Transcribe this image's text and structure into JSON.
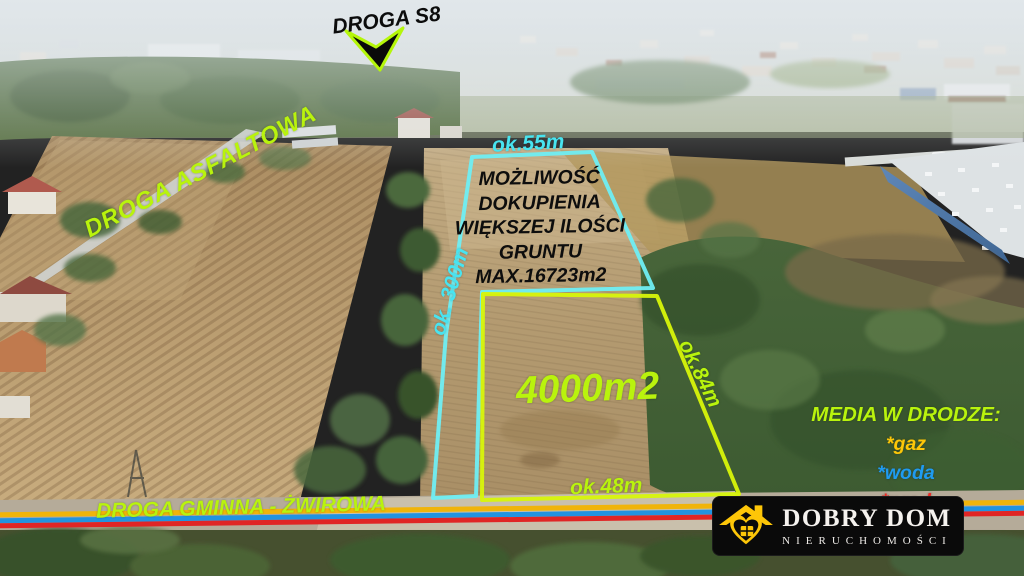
{
  "labels": {
    "droga_s8": "DROGA S8",
    "droga_asfaltowa": "DROGA ASFALTOWA",
    "droga_gminna": "DROGA GMINNA - ŻWIROWA",
    "top_width": "ok.55m",
    "left_length": "ok. 300m",
    "right_length": "ok.84m",
    "bottom_width": "ok.48m",
    "plot_area": "4000m2",
    "offer_lines": [
      "MOŻLIWOŚĆ",
      "DOKUPIENIA",
      "WIĘKSZEJ ILOŚCI",
      "GRUNTU",
      "MAX.16723m2"
    ],
    "media_header": "MEDIA W DRODZE:",
    "media_gaz": "*gaz",
    "media_woda": "*woda",
    "media_prad": "*prąd"
  },
  "logo": {
    "title": "DOBRY DOM",
    "subtitle": "NIERUCHOMOŚCI"
  },
  "colors": {
    "annotation_green": "#b9f30d",
    "annotation_cyan": "#48e4f0",
    "plot_outline_cyan": "#6feef3",
    "plot_outline_yellow": "#d8f50a",
    "gaz_yellow": "#fdc708",
    "woda_blue": "#1f9bf0",
    "prad_red": "#ef2a24",
    "utility_line_gaz": "#f0b40a",
    "utility_line_woda": "#2293e0",
    "utility_line_prad": "#e02525",
    "logo_yellow": "#fdc608"
  }
}
